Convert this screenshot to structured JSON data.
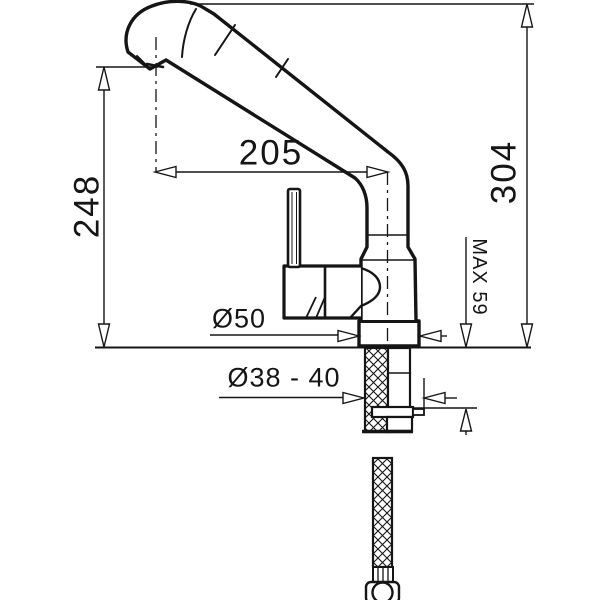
{
  "labels": {
    "spout_reach": "205",
    "height_to_spout": "248",
    "total_height": "304",
    "max_deck_thickness": "MAX 59",
    "base_diameter": "Ø50",
    "hole_diameter": "Ø38 - 40"
  },
  "colors": {
    "line": "#151515",
    "background": "#ffffff"
  }
}
